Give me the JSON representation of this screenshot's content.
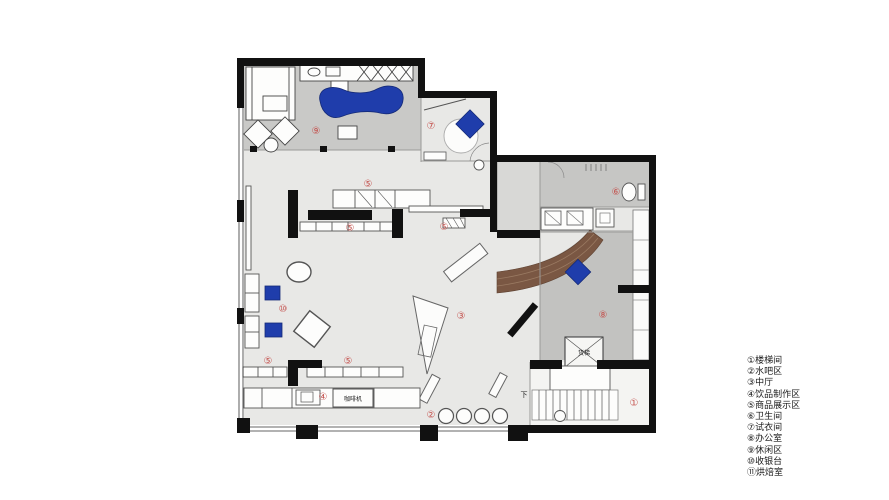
{
  "page": {
    "background": "#ffffff"
  },
  "legend": {
    "items": [
      {
        "num": "①",
        "label": "楼梯间"
      },
      {
        "num": "②",
        "label": "水吧区"
      },
      {
        "num": "③",
        "label": "中厅"
      },
      {
        "num": "④",
        "label": "饮品制作区"
      },
      {
        "num": "⑤",
        "label": "商品展示区"
      },
      {
        "num": "⑥",
        "label": "卫生间"
      },
      {
        "num": "⑦",
        "label": "试衣间"
      },
      {
        "num": "⑧",
        "label": "办公室"
      },
      {
        "num": "⑨",
        "label": "休闲区"
      },
      {
        "num": "⑩",
        "label": "收银台"
      },
      {
        "num": "⑪",
        "label": "烘焙室"
      }
    ]
  },
  "plan": {
    "annotations": {
      "coffee_machine": "咖啡机",
      "freight_elevator": "货梯",
      "stair_down": "下"
    },
    "room_labels": [
      {
        "num": "⑨",
        "x": 316,
        "y": 132
      },
      {
        "num": "⑦",
        "x": 431,
        "y": 127
      },
      {
        "num": "⑥",
        "x": 616,
        "y": 193
      },
      {
        "num": "⑤",
        "x": 368,
        "y": 185
      },
      {
        "num": "⑤",
        "x": 350,
        "y": 229
      },
      {
        "num": "⑤",
        "x": 444,
        "y": 228
      },
      {
        "num": "⑩",
        "x": 283,
        "y": 310
      },
      {
        "num": "③",
        "x": 461,
        "y": 317
      },
      {
        "num": "⑧",
        "x": 603,
        "y": 316
      },
      {
        "num": "⑤",
        "x": 268,
        "y": 362
      },
      {
        "num": "⑤",
        "x": 348,
        "y": 362
      },
      {
        "num": "④",
        "x": 323,
        "y": 398
      },
      {
        "num": "②",
        "x": 431,
        "y": 416
      },
      {
        "num": "①",
        "x": 634,
        "y": 404
      }
    ],
    "colors": {
      "wall": "#111111",
      "floor_hall": "#e8e8e6",
      "floor_lounge": "#c9c9c7",
      "floor_office": "#c2c2c0",
      "floor_bath": "#c6c6c4",
      "wood": "#7a5743",
      "accent_blue": "#1f3dab",
      "label_red": "#c4524e"
    }
  }
}
